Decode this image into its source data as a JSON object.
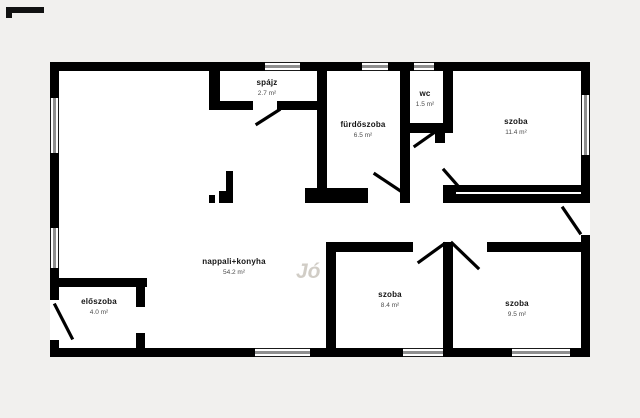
{
  "floorplan": {
    "title": "apartment floor plan",
    "colors": {
      "wall": "#000000",
      "background": "#f1f0ee",
      "interior": "#ffffff",
      "window_gray": "#8f8f8f",
      "area_text": "#4d4d4d"
    },
    "watermark": "Jó",
    "rooms": [
      {
        "id": "spajz",
        "name": "spájz",
        "area": "2.7 m²"
      },
      {
        "id": "furdoszoba",
        "name": "fürdőszoba",
        "area": "6.5 m²"
      },
      {
        "id": "wc",
        "name": "wc",
        "area": "1.5 m²"
      },
      {
        "id": "szoba-1",
        "name": "szoba",
        "area": "11.4 m²"
      },
      {
        "id": "nappali-konyha",
        "name": "nappali+konyha",
        "area": "54.2 m²"
      },
      {
        "id": "eloszoba",
        "name": "előszoba",
        "area": "4.0 m²"
      },
      {
        "id": "szoba-2",
        "name": "szoba",
        "area": "8.4 m²"
      },
      {
        "id": "szoba-3",
        "name": "szoba",
        "area": "9.5 m²"
      }
    ]
  }
}
